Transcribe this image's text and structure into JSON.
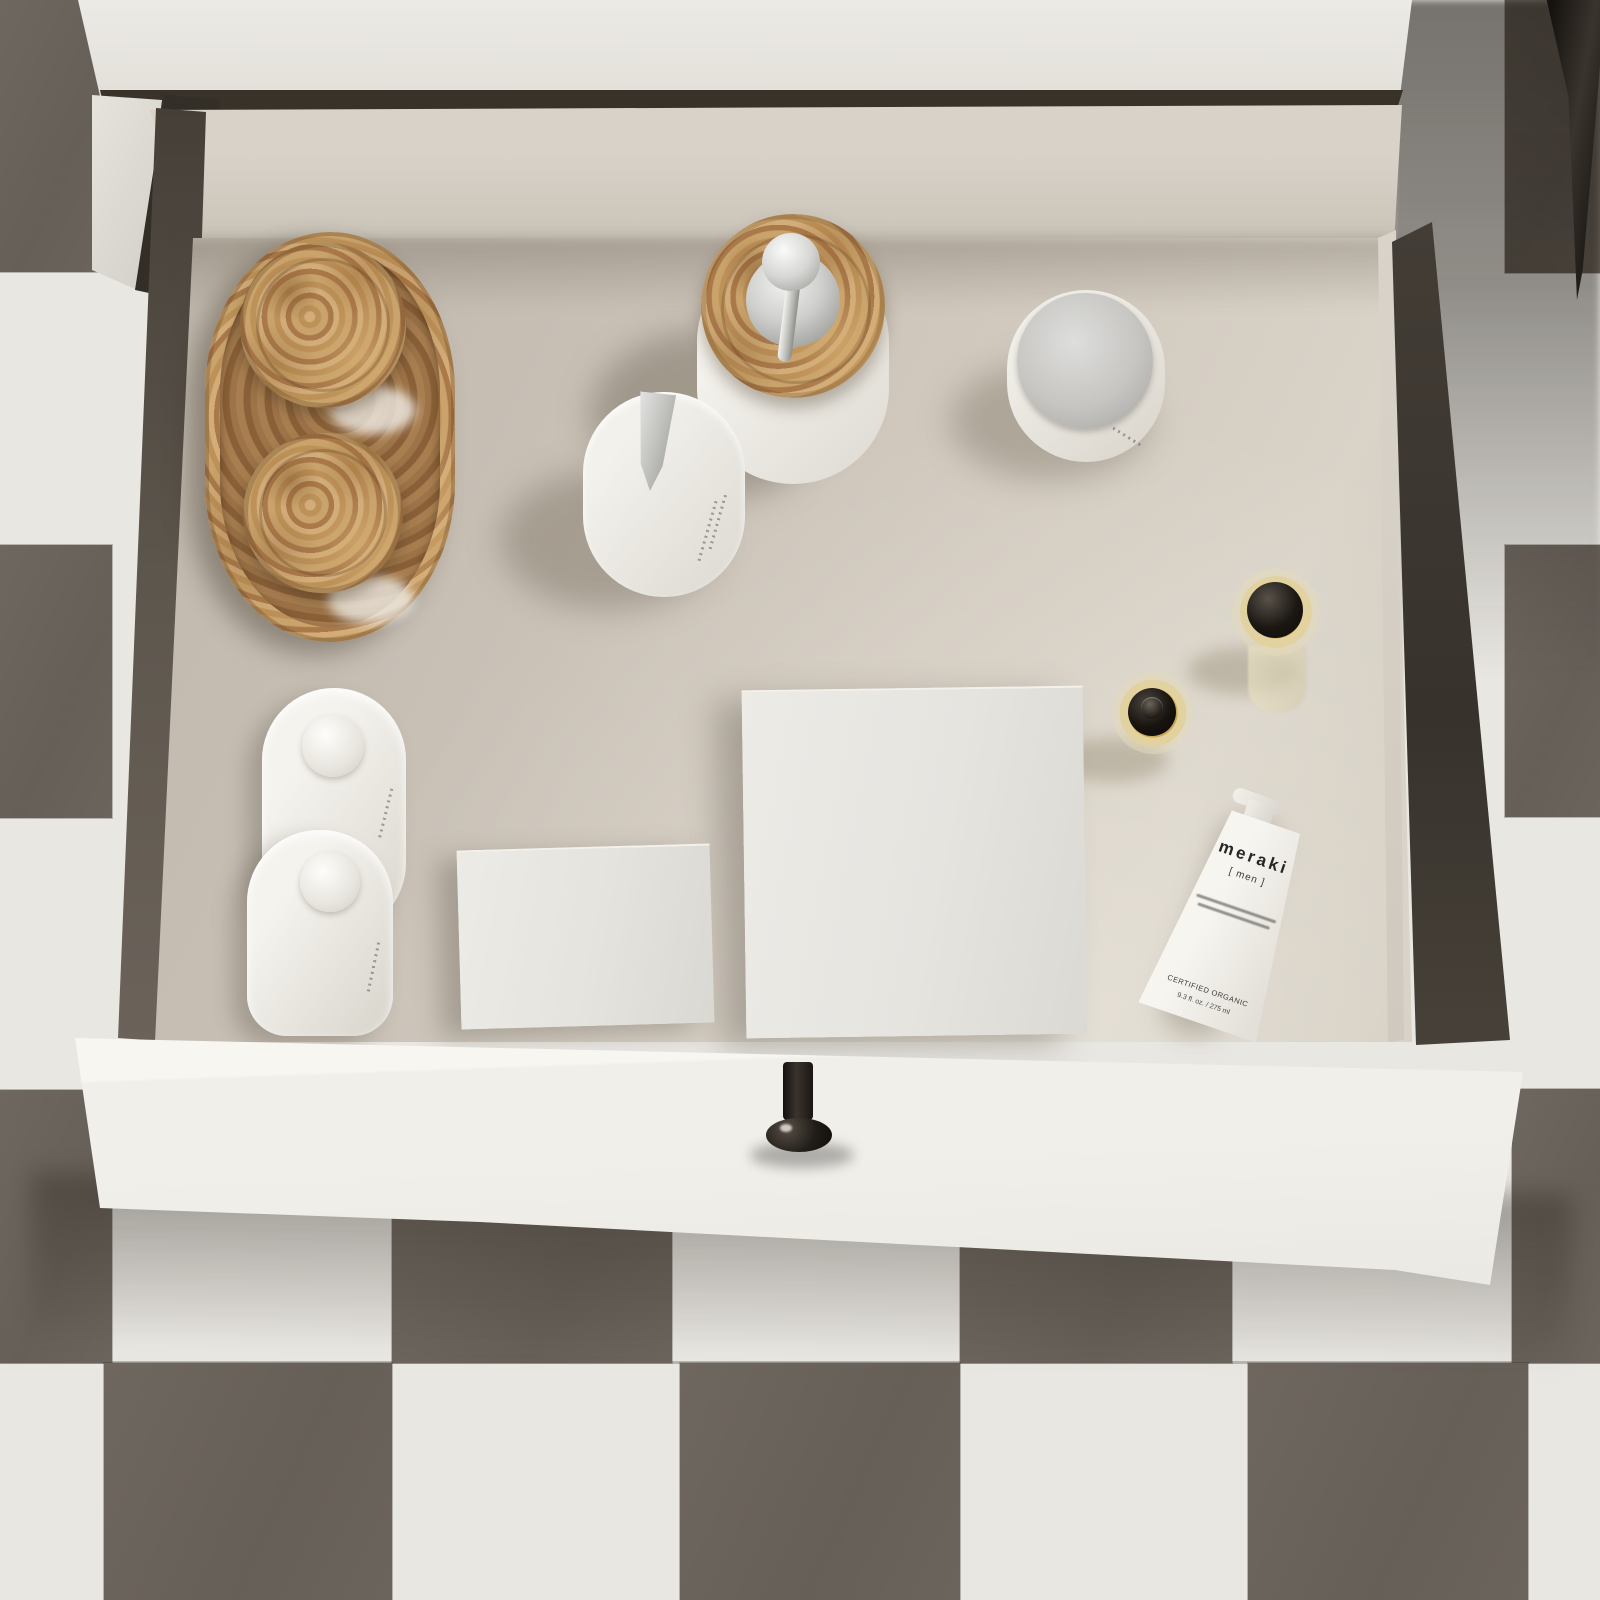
{
  "scene": {
    "description": "Top-down view of an open white bathroom vanity drawer filled with toiletries, standing on a white and dark taupe checkerboard tile floor",
    "objects": [
      "burl wood oval tray",
      "two burl-wood lidded jars",
      "soap dispenser with burl wood lid and chrome pump",
      "white pump bottle with chrome spout",
      "cream jar with chrome lid",
      "two amber glass bottles with black caps",
      "two white product boxes",
      "two white dome-cap lotion bottles",
      "white cosmetic tube",
      "black drawer knob",
      "dark cone-shaped object on floor"
    ]
  },
  "tube": {
    "brand": "meraki",
    "line": "[ men ]",
    "certified": "CERTIFIED ORGANIC",
    "volume": "9.3 fl. oz. / 275 ml"
  },
  "palette": {
    "floor_light": "#e9e7e2",
    "floor_dark": "#6b645c",
    "drawer_interior": "#cdc5ba",
    "cabinet_white": "#edebe6",
    "wood": "#c09a63",
    "chrome": "#c9c9c7",
    "amber_glass": "#caa84e",
    "cap_black": "#1b1713"
  }
}
